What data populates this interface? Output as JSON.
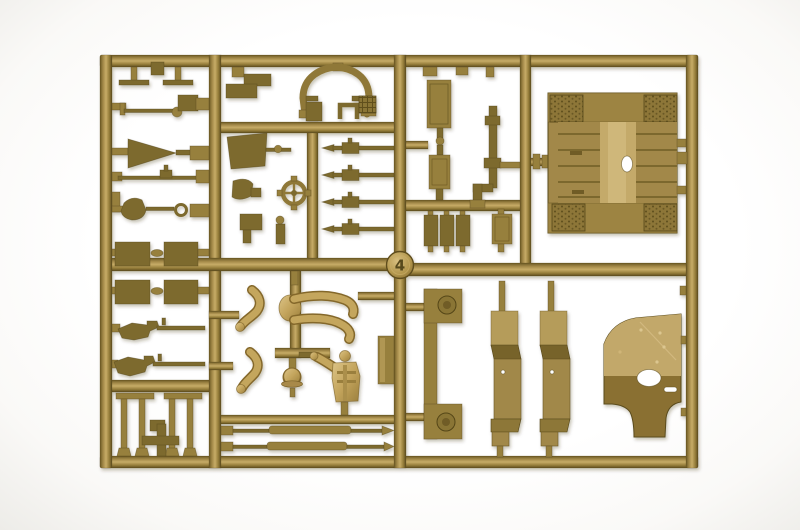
{
  "meta": {
    "type": "photograph",
    "subject": "Injection-molded plastic model kit sprue (parts tree) in dark-tan styrene photographed on a white background",
    "orientation": "landscape"
  },
  "sprue": {
    "gate_marker_number": "4",
    "material": "dark tan styrene plastic",
    "background_color": "#ffffff",
    "colors": {
      "plastic_core": "#97803e",
      "plastic_highlight": "#c7ac67",
      "plastic_shadow": "#6a5823",
      "dark_part": "#7d6a2e",
      "figure_gold": "#c8ab62",
      "bed_center_light": "#c4aa6a",
      "cab_lower_dark": "#8a7031",
      "strip_light": "#b59c5a"
    },
    "parts_inventory": [
      "rectangular runner frame",
      "gate marker disc numbered 4",
      "foot pedals (2)",
      "control lever linkages (3)",
      "funnel / horn cone",
      "stowage lids (4 paired rectangles)",
      "rifles (2)",
      "rail posts (4) with cross bracket",
      "mudflap bracket",
      "gun-ring arch with mount feet",
      "hatched small plate",
      "windshield panel",
      "steering wheel",
      "seat bracket",
      "pointed tool stakes (4)",
      "figure arms (2)",
      "seated figure legs",
      "helmet",
      "driver torso figure",
      "tall flat plate",
      "axle rods (2)",
      "door panels (2)",
      "barrel / exhaust pipe with elbow",
      "jerry-can blocks (4)",
      "cargo bed floor panel with tread pads and oval hole",
      "C-shaped bumper bracket with bosses",
      "fender strips (2)",
      "cab rear panel with oval opening"
    ]
  }
}
